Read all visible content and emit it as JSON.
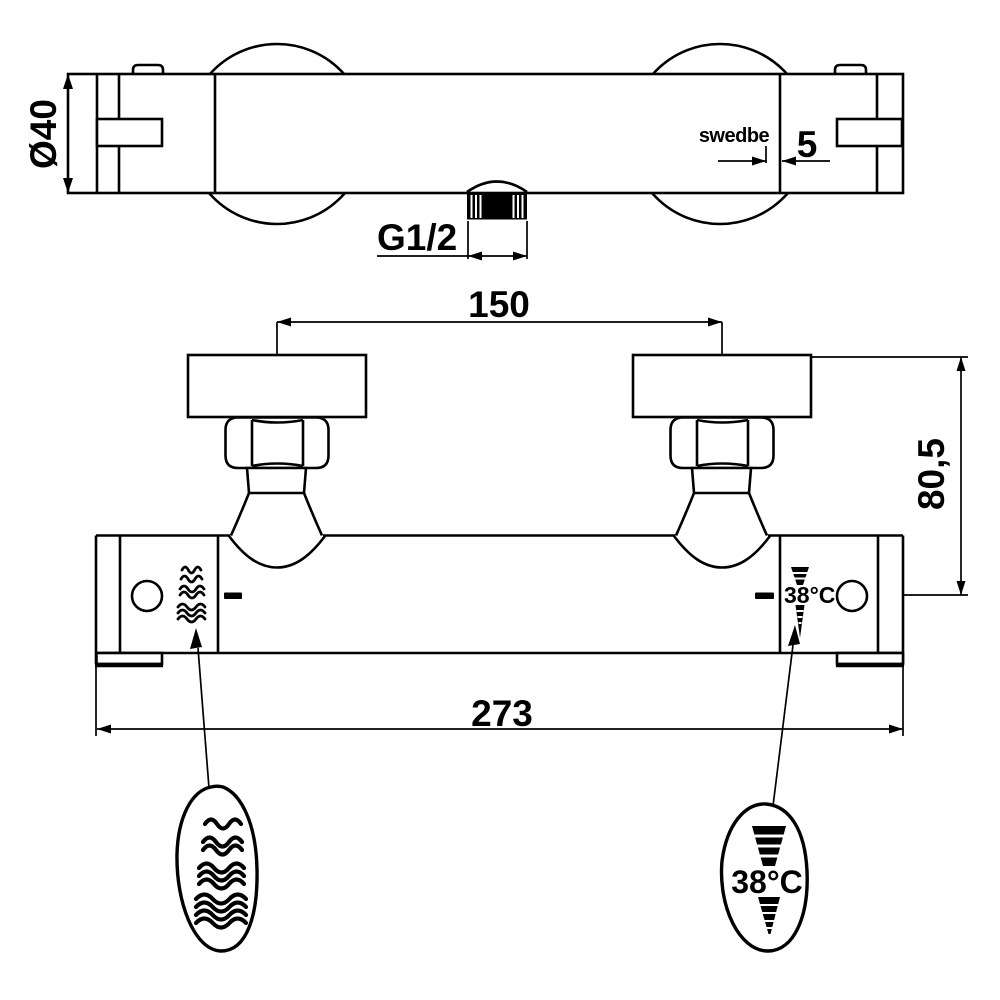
{
  "drawing": {
    "brand": "swedbe",
    "dimensions": {
      "bar_diameter": "Ø40",
      "logo_offset": "5",
      "outlet_thread": "G1/2",
      "inlet_spacing": "150",
      "mount_height": "80,5",
      "overall_width": "273"
    },
    "temperature": {
      "body_label": "38°C",
      "balloon_label": "38°C"
    },
    "icons": {
      "hot_water": "wavy-lines-icon",
      "temperature_limit": "segmented-wedge-icon"
    },
    "colors": {
      "ink": "#000000",
      "paper": "#ffffff"
    }
  }
}
